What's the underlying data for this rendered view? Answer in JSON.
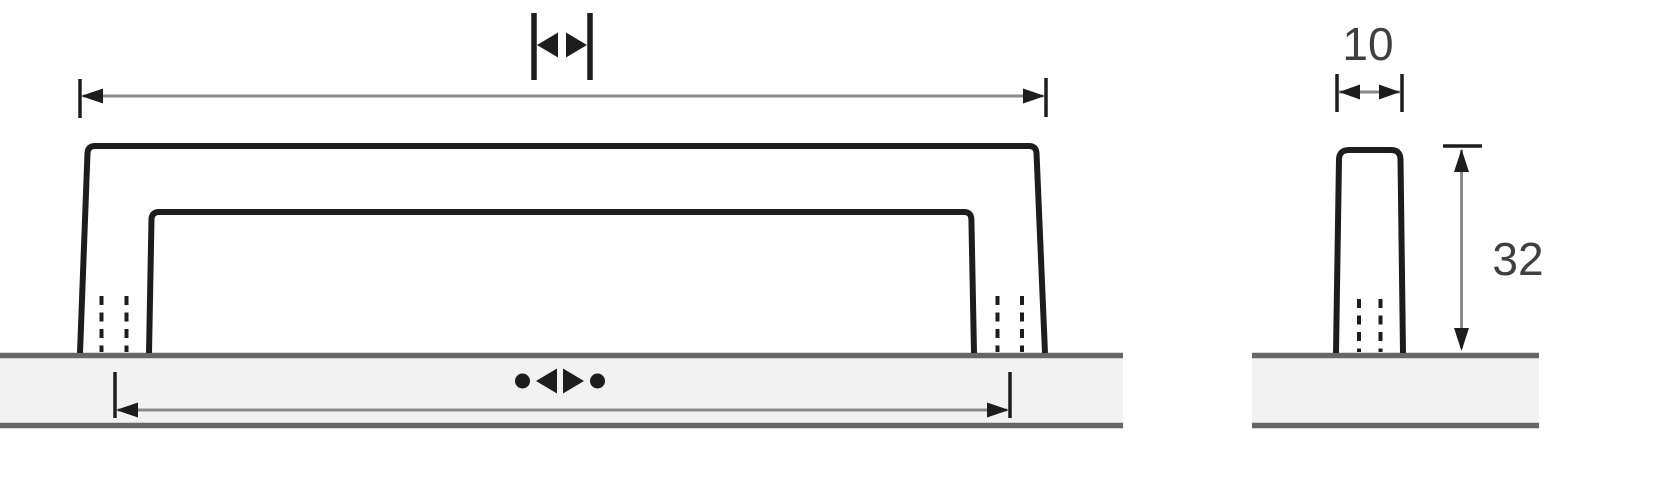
{
  "drawing": {
    "side_view": {
      "width_value": "10",
      "height_value": "32"
    },
    "icons": {
      "overall_length": "|◀ ▶|",
      "hole_center_distance": "●◀ ▶●"
    },
    "colors": {
      "outline": "#1d1d1b",
      "dimension_line": "#8a8a8a",
      "dimension_marks": "#1d1d1b",
      "panel_fill": "#f2f2f2",
      "panel_edge": "#666666",
      "label_text": "#3f3f3f",
      "background": "#ffffff"
    }
  }
}
